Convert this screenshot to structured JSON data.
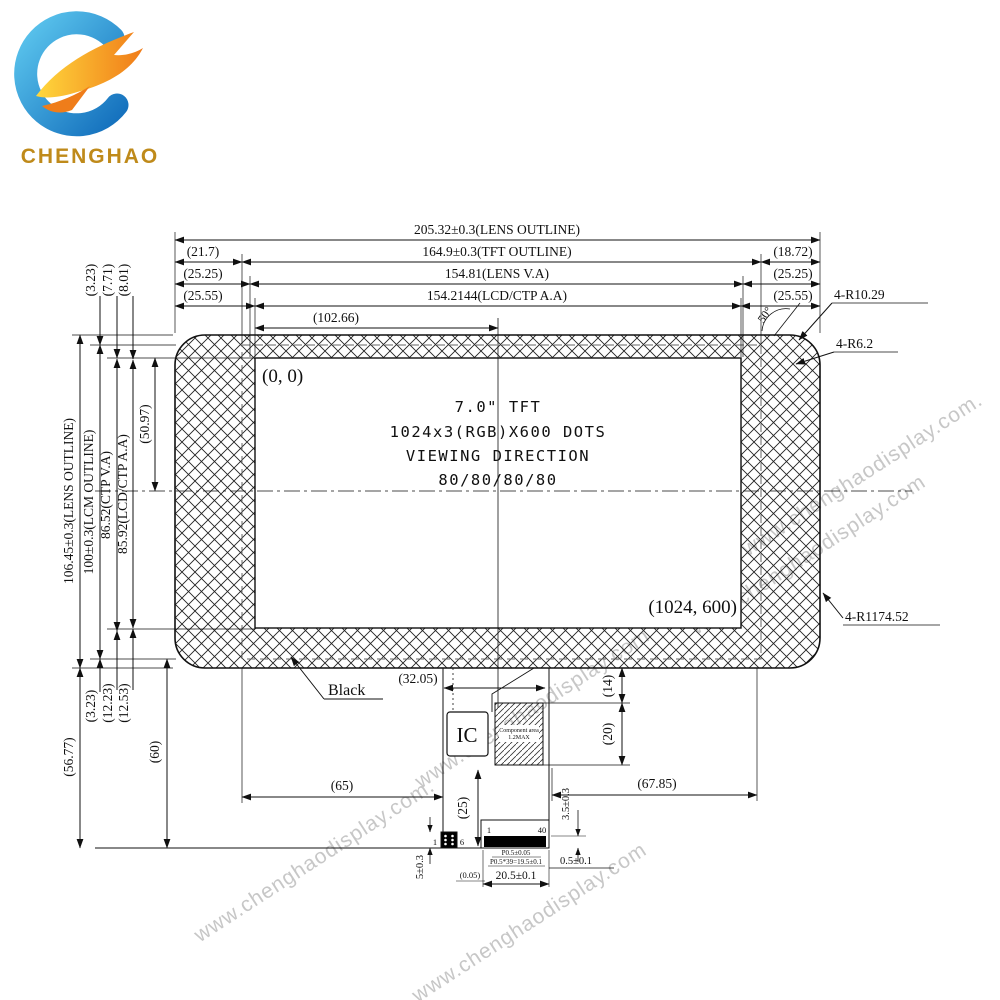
{
  "logo": {
    "company": "CHENGHAO"
  },
  "watermark": {
    "text": "www.chenghaodisplay.com",
    "text_dot": "www.chenghaodisplay.com."
  },
  "display": {
    "origin": "(0, 0)",
    "corner": "(1024, 600)",
    "size_line": "7.0\" TFT",
    "resolution_line": "1024x3(RGB)X600 DOTS",
    "viewing_line1": "VIEWING DIRECTION",
    "viewing_line2": "80/80/80/80",
    "black_label": "Black",
    "ic_label": "IC",
    "component_line1": "Component area",
    "component_line2": "1.2MAX"
  },
  "dims_top": {
    "lens_outline": "205.32±0.3(LENS OUTLINE)",
    "tft_left": "(21.7)",
    "tft_outline": "164.9±0.3(TFT OUTLINE)",
    "tft_right": "(18.72)",
    "lens_va_left": "(25.25)",
    "lens_va": "154.81(LENS V.A)",
    "lens_va_right": "(25.25)",
    "aa_left": "(25.55)",
    "aa": "154.2144(LCD/CTP A.A)",
    "aa_right": "(25.55)",
    "half_aa": "(102.66)"
  },
  "dims_left": {
    "lens_outline": "106.45±0.3(LENS OUTLINE)",
    "lcm_outline": "100±0.3(LCM OUTLINE)",
    "ctp_va": "86.52(CTP V.A)",
    "aa": "85.92(LCD/CTP A.A)",
    "half_aa": "(50.97)",
    "top_gap_lcm": "(3.23)",
    "top_gap_ctp": "(7.71)",
    "top_gap_aa": "(8.01)",
    "bottom_gap_lcm": "(3.23)",
    "bottom_gap_ctp": "(12.23)",
    "bottom_gap_aa": "(12.53)",
    "fpc_drop_lens": "(56.77)",
    "fpc_drop_lcm": "(60)"
  },
  "dims_right": {
    "corner_r1": "4-R10.29",
    "corner_r2": "4-R6.2",
    "edge_r": "4-R1174.52",
    "corner_angle": "50°"
  },
  "dims_bottom": {
    "ic_offset": "(32.05)",
    "fpc_left": "(65)",
    "fpc_right": "(67.85)",
    "comp_gap": "(14)",
    "comp_h": "(20)",
    "fpc_len": "(25)",
    "conn_thk": "3.5±0.3",
    "stiffener": "5±0.3",
    "pin_margin": "0.5±0.1",
    "gap_small": "(0.05)",
    "conn_w": "20.5±0.1",
    "pitch": "P0.5±0.05",
    "pitch_total": "P0.5*39=19.5±0.1",
    "pin1": "1",
    "pin40": "40",
    "spin1": "1",
    "spin6": "6"
  }
}
